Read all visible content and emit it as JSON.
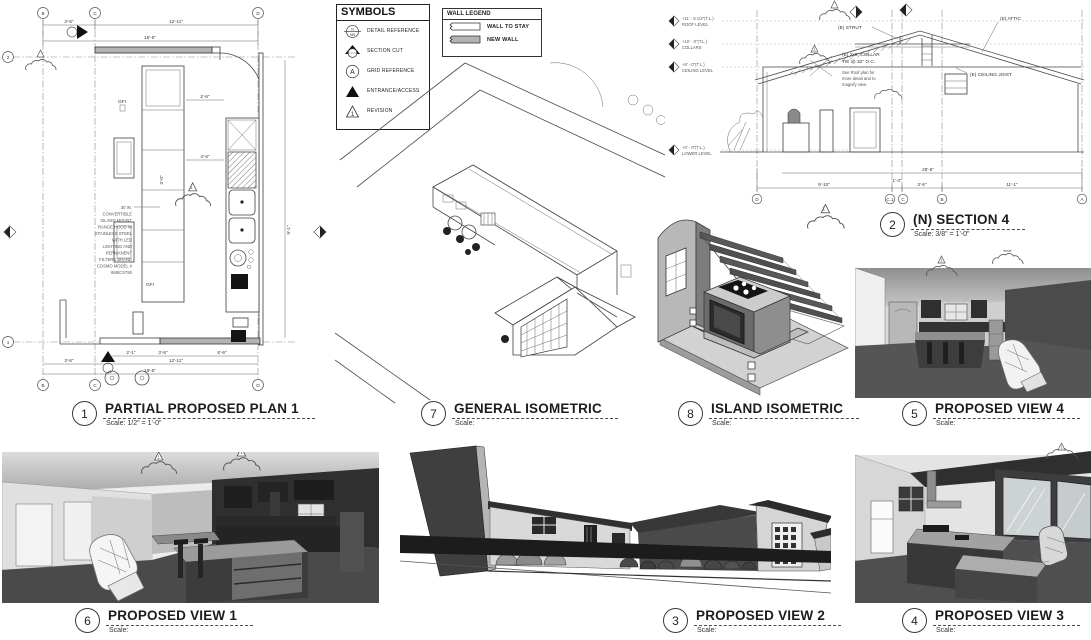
{
  "palette": {
    "ink": "#3a3a3a",
    "new_wall_fill": "#b3b3b3",
    "wall_stay_fill": "#ffffff",
    "render_floor": "#4c4c4c",
    "render_dark": "#2e2e2e",
    "render_wall": "#e3e3e3"
  },
  "legend_symbols": {
    "title": "SYMBOLS",
    "items": [
      {
        "label": "DETAIL REFERENCE"
      },
      {
        "label": "SECTION CUT"
      },
      {
        "label": "GRID REFERENCE"
      },
      {
        "label": "ENTRANCE/ACCESS"
      },
      {
        "label": "REVISION"
      }
    ],
    "detail_top": "N",
    "detail_bottom": "NN",
    "grid_letter": "A",
    "revision_number": "1"
  },
  "legend_wall": {
    "title": "WALL LEGEND",
    "items": [
      {
        "label": "WALL TO STAY",
        "fill": "#ffffff"
      },
      {
        "label": "NEW  WALL",
        "fill": "#b3b3b3"
      }
    ]
  },
  "titles": {
    "plan": {
      "number": "1",
      "title": "PARTIAL PROPOSED PLAN 1",
      "scale": "Scale: 1/2\" = 1'-0\""
    },
    "general_iso": {
      "number": "7",
      "title": "GENERAL ISOMETRIC",
      "scale": "Scale:"
    },
    "section": {
      "number": "2",
      "title": "(N) SECTION 4",
      "scale": "Scale: 3/8\" = 1'-0\""
    },
    "island_iso": {
      "number": "8",
      "title": "ISLAND ISOMETRIC",
      "scale": "Scale:"
    },
    "view4": {
      "number": "5",
      "title": "PROPOSED VIEW 4",
      "scale": "Scale:"
    },
    "view1": {
      "number": "6",
      "title": "PROPOSED VIEW 1",
      "scale": "Scale:"
    },
    "view2": {
      "number": "3",
      "title": "PROPOSED VIEW 2",
      "scale": "Scale:"
    },
    "view3": {
      "number": "4",
      "title": "PROPOSED VIEW 3",
      "scale": "Scale:"
    }
  },
  "plan": {
    "grid": {
      "b": "B",
      "c": "C",
      "d": "D",
      "two": "2",
      "one": "1"
    },
    "dims": {
      "top_1": "3'-6\"",
      "top_2": "12'-11\"",
      "top_total": "16'-5\"",
      "bot_1": "3'-6\"",
      "bot_2": "12'-11\"",
      "bot_total": "16'-5\"",
      "int_1": "2'-1\"",
      "int_2": "3'-6\"",
      "int_3": "8'-6\"",
      "island_gap": "2'-6\"",
      "aisle": "4'-6\"",
      "island_w": "3'-0\"",
      "right_v": "9'-1\""
    },
    "gfi": "GFI",
    "hood_note_lines": [
      "30 IN.",
      "CONVERTIBLE",
      "ISLAND MOUNT",
      "RANGE HOOD IN",
      "STAINLESS STEEL",
      "WITH LED",
      "LIGHTING AND",
      "PERMANENT",
      "FILTERS BRAND",
      "COSMO MODEL #",
      "668ICS750"
    ],
    "revision_number": "1"
  },
  "section": {
    "levels": [
      {
        "elev": "+11' - 8 1/2\"(T.L.)",
        "name": "ROOF LEVEL"
      },
      {
        "elev": "+10' - 0\"(T.L.)",
        "name": "COLLARS"
      },
      {
        "elev": "+8' - 0\"(T.L.)",
        "name": "CEILING LEVEL"
      },
      {
        "elev": "+0' - 0\"(T.L.)",
        "name": "LOWER LEVEL"
      }
    ],
    "labels": {
      "strut": "(E) STRUT",
      "attic": "(E) ATTIC",
      "collar_1": "(E) 2x6\" COLLAR",
      "collar_2": "TIE @ 32\" O.C.",
      "note_1": "See Roof plan for",
      "note_2": "more detail and to",
      "note_3": "magnify view",
      "joist": "(E) CEILING JOIST"
    },
    "dims": {
      "total": "28'-6\"",
      "d1": "9'-10\"",
      "d2": "1'-3\"",
      "d3": "3'-6\"",
      "d4": "11'-1\""
    },
    "grid": [
      "D",
      "C.1",
      "C",
      "B",
      "A"
    ],
    "revision_number": "1"
  }
}
